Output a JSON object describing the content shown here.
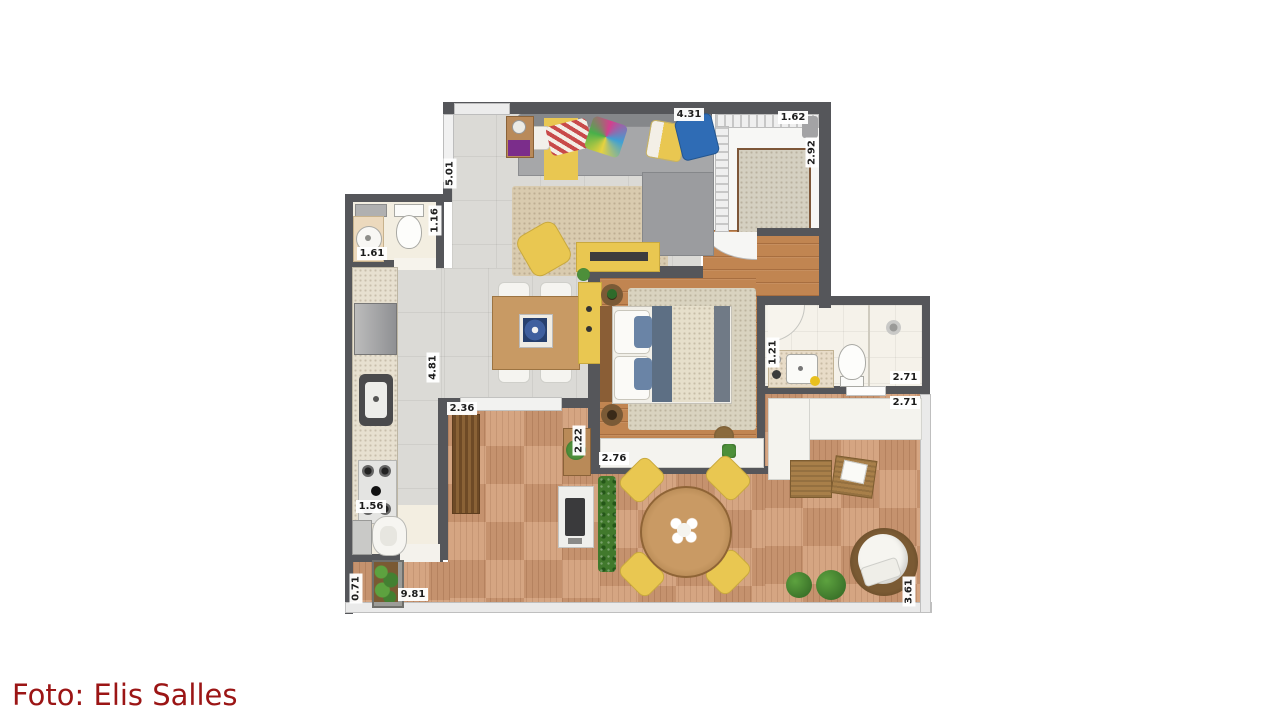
{
  "caption": {
    "text": "Foto: Elis Salles",
    "color": "#9b1515"
  },
  "palette": {
    "background": "#ffffff",
    "wall": "#55565a",
    "tile_floor": "#dbdad6",
    "wood_floor": "#c18551",
    "deck_floor": "#d09b74",
    "bath_floor": "#f5f2ea",
    "accent_yellow": "#e9c751",
    "sofa_gray": "#a6a7a9",
    "hedge_green": "#41792c",
    "caption_red": "#9b1515"
  },
  "dimensions": [
    {
      "value": "4.31",
      "orientation": "horizontal",
      "area": "living-room-top"
    },
    {
      "value": "1.62",
      "orientation": "horizontal",
      "area": "entry-closet-top"
    },
    {
      "value": "2.92",
      "orientation": "vertical",
      "area": "entry-closet-right"
    },
    {
      "value": "5.01",
      "orientation": "vertical",
      "area": "living-room-left"
    },
    {
      "value": "1.16",
      "orientation": "vertical",
      "area": "lavabo-right"
    },
    {
      "value": "1.61",
      "orientation": "horizontal",
      "area": "lavabo"
    },
    {
      "value": "4.81",
      "orientation": "vertical",
      "area": "kitchen"
    },
    {
      "value": "2.36",
      "orientation": "horizontal",
      "area": "terrace-upper-left"
    },
    {
      "value": "2.22",
      "orientation": "vertical",
      "area": "terrace-bench"
    },
    {
      "value": "2.76",
      "orientation": "horizontal",
      "area": "bedroom-wardrobe"
    },
    {
      "value": "1.21",
      "orientation": "vertical",
      "area": "bathroom-left"
    },
    {
      "value": "2.71",
      "orientation": "horizontal",
      "area": "bathroom"
    },
    {
      "value": "2.71",
      "orientation": "horizontal",
      "area": "terrace-sofa"
    },
    {
      "value": "1.56",
      "orientation": "horizontal",
      "area": "kitchen-bottom"
    },
    {
      "value": "0.71",
      "orientation": "vertical",
      "area": "terrace-planter"
    },
    {
      "value": "9.81",
      "orientation": "horizontal",
      "area": "terrace-bottom"
    },
    {
      "value": "3.61",
      "orientation": "vertical",
      "area": "terrace-right"
    }
  ],
  "objects": [
    "sectional-sofa",
    "throw-pillows",
    "area-rug",
    "armchair",
    "tv-console",
    "side-table",
    "dining-table",
    "dining-chairs",
    "sideboard",
    "kitchen-counter",
    "refrigerator",
    "sink",
    "cooktop",
    "lavabo-toilet",
    "lavabo-washbasin",
    "double-bed",
    "nightstands",
    "bedroom-rug",
    "wardrobe",
    "bathroom-vanity",
    "toilet",
    "shower",
    "laundry-tub",
    "deck-bench",
    "barbecue-grill",
    "planter-hedge",
    "outdoor-dining-table",
    "outdoor-chairs",
    "outdoor-sofa",
    "wicker-ottomans",
    "round-lounge-chair",
    "bushes",
    "planter-box",
    "entry-closet-shelving",
    "doormat"
  ]
}
